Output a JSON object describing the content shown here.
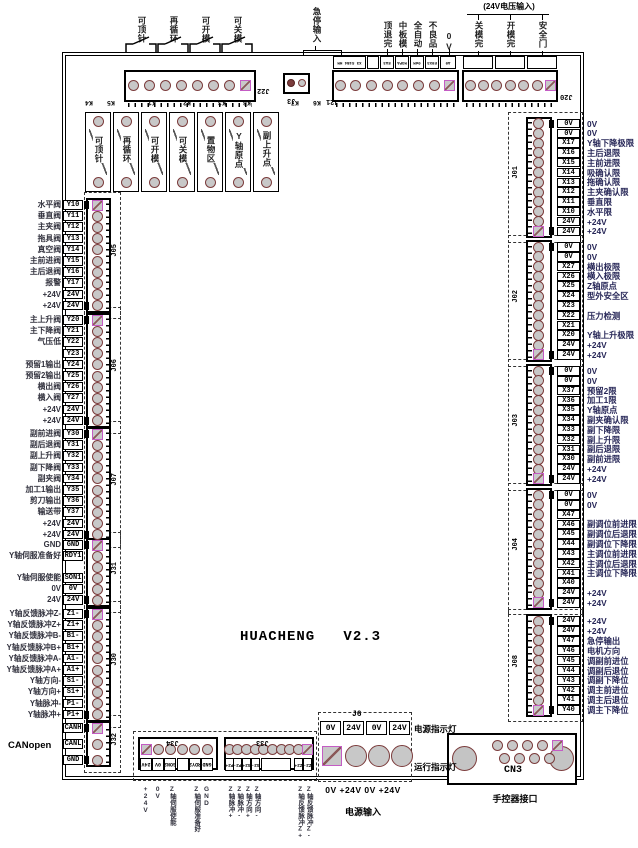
{
  "title": "HUACHENG   V2.3",
  "canopen_label": "CANopen",
  "colors": {
    "pin_ring": "#7b3c3c",
    "pin_fill": "#c8c8c8",
    "square_pin": "#c45cc4",
    "label_ink": "#272758",
    "line": "#000000"
  },
  "top": {
    "j22": {
      "name": "J22",
      "switch_labels": [
        "可顶针",
        "再循环",
        "可开模",
        "可关模"
      ],
      "pins": 8
    },
    "j3": {
      "name": "J3"
    },
    "relay_tags": [
      "K4",
      "K5",
      "K1",
      "K2",
      "K3",
      "K8",
      "K7",
      "K6"
    ],
    "j21": {
      "name": "J21",
      "bracket_label": "急停输入",
      "labels": [
        "顶退完",
        "中板模",
        "全自动",
        "不良品",
        "0V"
      ],
      "pin_boxes": [
        "X3 S1B4 HM",
        "",
        "EA3",
        "M3PA",
        "0dM",
        "E0X3",
        "A0"
      ],
      "pins": 8
    },
    "j20": {
      "name": "J20",
      "bracket_label": "(24V电压输入)",
      "labels": [
        "关模完",
        "开模完",
        "安全门"
      ],
      "pins": 7
    }
  },
  "relay_row": [
    "可顶针",
    "再循环",
    "可开模",
    "可关模",
    "置物区",
    "Y轴原点",
    "副上升点"
  ],
  "left_blocks": [
    {
      "name": "J05",
      "rows": [
        [
          "水平阀",
          "Y10"
        ],
        [
          "垂直阀",
          "Y11"
        ],
        [
          "主夹阀",
          "Y12"
        ],
        [
          "拖具阀",
          "Y13"
        ],
        [
          "真空阀",
          "Y14"
        ],
        [
          "主前进阀",
          "Y15"
        ],
        [
          "主后退阀",
          "Y16"
        ],
        [
          "报警",
          "Y17"
        ],
        [
          "+24V",
          "24V"
        ],
        [
          "+24V",
          "24V"
        ]
      ]
    },
    {
      "name": "J06",
      "rows": [
        [
          "主上升阀",
          "Y20"
        ],
        [
          "主下降阀",
          "Y21"
        ],
        [
          "气压低",
          "Y22"
        ],
        [
          "",
          "Y23"
        ],
        [
          "预留1输出",
          "Y24"
        ],
        [
          "预留2输出",
          "Y25"
        ],
        [
          "横出阀",
          "Y26"
        ],
        [
          "横入阀",
          "Y27"
        ],
        [
          "+24V",
          "24V"
        ],
        [
          "+24V",
          "24V"
        ]
      ]
    },
    {
      "name": "J07",
      "rows": [
        [
          "副前进阀",
          "Y30"
        ],
        [
          "副后退阀",
          "Y31"
        ],
        [
          "副上升阀",
          "Y32"
        ],
        [
          "副下降阀",
          "Y33"
        ],
        [
          "副夹阀",
          "Y34"
        ],
        [
          "加工1输出",
          "Y35"
        ],
        [
          "剪刀输出",
          "Y36"
        ],
        [
          "输送带",
          "Y37"
        ],
        [
          "+24V",
          "24V"
        ],
        [
          "+24V",
          "24V"
        ]
      ]
    },
    {
      "name": "J31",
      "rows": [
        [
          "GND",
          "GND"
        ],
        [
          "Y轴伺服准备好",
          "RDY1"
        ],
        [
          "",
          ""
        ],
        [
          "Y轴伺服使能",
          "SON1"
        ],
        [
          "0V",
          "0V"
        ],
        [
          "24V",
          "24V"
        ]
      ]
    },
    {
      "name": "J30",
      "rows": [
        [
          "Y轴反馈脉冲Z-",
          "Z1-"
        ],
        [
          "Y轴反馈脉冲Z+",
          "Z1+"
        ],
        [
          "Y轴反馈脉冲B-",
          "B1-"
        ],
        [
          "Y轴反馈脉冲B+",
          "B1+"
        ],
        [
          "Y轴反馈脉冲A-",
          "A1-"
        ],
        [
          "Y轴反馈脉冲A+",
          "A1+"
        ],
        [
          "Y轴方向-",
          "S1-"
        ],
        [
          "Y轴方向+",
          "S1+"
        ],
        [
          "Y轴脉冲-",
          "P1-"
        ],
        [
          "Y轴脉冲+",
          "P1+"
        ]
      ]
    },
    {
      "name": "J32",
      "rows": [
        [
          "",
          "CANH"
        ],
        [
          "",
          "CANL"
        ],
        [
          "",
          "GND"
        ]
      ]
    }
  ],
  "right_blocks": [
    {
      "name": "J01",
      "rows": [
        [
          "0V",
          "0V"
        ],
        [
          "0V",
          "0V"
        ],
        [
          "X17",
          "Y轴下降极限"
        ],
        [
          "X16",
          "主后退限"
        ],
        [
          "X15",
          "主前进限"
        ],
        [
          "X14",
          "吸确认限"
        ],
        [
          "X13",
          "拖确认限"
        ],
        [
          "X12",
          "主夹确认限"
        ],
        [
          "X11",
          "垂直限"
        ],
        [
          "X10",
          "水平限"
        ],
        [
          "24V",
          "+24V"
        ],
        [
          "24V",
          "+24V"
        ]
      ]
    },
    {
      "name": "J02",
      "rows": [
        [
          "0V",
          "0V"
        ],
        [
          "0V",
          "0V"
        ],
        [
          "X27",
          "横出极限"
        ],
        [
          "X26",
          "横入极限"
        ],
        [
          "X25",
          "Z轴原点"
        ],
        [
          "X24",
          "型外安全区"
        ],
        [
          "X23",
          ""
        ],
        [
          "X22",
          "压力检测"
        ],
        [
          "X21",
          ""
        ],
        [
          "X20",
          "Y轴上升极限"
        ],
        [
          "24V",
          "+24V"
        ],
        [
          "24V",
          "+24V"
        ]
      ]
    },
    {
      "name": "J03",
      "rows": [
        [
          "0V",
          "0V"
        ],
        [
          "0V",
          "0V"
        ],
        [
          "X37",
          "预留2限"
        ],
        [
          "X36",
          "加工1限"
        ],
        [
          "X35",
          "Y轴原点"
        ],
        [
          "X34",
          "副夹确认限"
        ],
        [
          "X33",
          "副下降限"
        ],
        [
          "X32",
          "副上升限"
        ],
        [
          "X31",
          "副后退限"
        ],
        [
          "X30",
          "副前进限"
        ],
        [
          "24V",
          "+24V"
        ],
        [
          "24V",
          "+24V"
        ]
      ]
    },
    {
      "name": "J04",
      "rows": [
        [
          "0V",
          "0V"
        ],
        [
          "0V",
          "0V"
        ],
        [
          "X47",
          ""
        ],
        [
          "X46",
          "副调位前进限"
        ],
        [
          "X45",
          "副调位后退限"
        ],
        [
          "X44",
          "副调位下降限"
        ],
        [
          "X43",
          "主调位前进限"
        ],
        [
          "X42",
          "主调位后退限"
        ],
        [
          "X41",
          "主调位下降限"
        ],
        [
          "X40",
          ""
        ],
        [
          "24V",
          "+24V"
        ],
        [
          "24V",
          "+24V"
        ]
      ]
    },
    {
      "name": "J08",
      "rows": [
        [
          "24V",
          "+24V"
        ],
        [
          "24V",
          "+24V"
        ],
        [
          "Y47",
          "急停输出"
        ],
        [
          "Y46",
          "电机方向"
        ],
        [
          "Y45",
          "调副前进位"
        ],
        [
          "Y44",
          "调副后退位"
        ],
        [
          "Y43",
          "调副下降位"
        ],
        [
          "Y42",
          "调主前进位"
        ],
        [
          "Y41",
          "调主后退位"
        ],
        [
          "Y40",
          "调主下降位"
        ]
      ]
    }
  ],
  "bottom": {
    "j34": {
      "name": "J34",
      "pins": [
        [
          "24V",
          "+24V"
        ],
        [
          "0V",
          "0V"
        ],
        [
          "SON2",
          "Z轴伺服使能"
        ],
        [
          "",
          ""
        ],
        [
          "RDY2",
          "Z轴伺服准备好"
        ],
        [
          "GND",
          "GND"
        ]
      ]
    },
    "j33": {
      "name": "J33",
      "pins": [
        [
          "P2+",
          "Z轴脉冲+"
        ],
        [
          "P2-",
          "Z轴脉冲-"
        ],
        [
          "S2+",
          "Z轴方向+"
        ],
        [
          "S2-",
          "Z轴方向-"
        ],
        [
          "",
          ""
        ],
        [
          "",
          ""
        ],
        [
          "",
          ""
        ],
        [
          "",
          ""
        ],
        [
          "Z2+",
          "Z轴反馈脉冲Z+"
        ],
        [
          "Z2-",
          "Z轴反馈脉冲Z-"
        ]
      ]
    },
    "j6": {
      "name": "J6",
      "terminals": [
        "0V",
        "24V",
        "0V",
        "24V"
      ],
      "below": "0V +24V 0V +24V",
      "caption": "电源输入",
      "led_labels": [
        "电源指示灯",
        "运行指示灯"
      ]
    },
    "cn3": {
      "name": "CN3",
      "caption": "手控器接口"
    }
  }
}
